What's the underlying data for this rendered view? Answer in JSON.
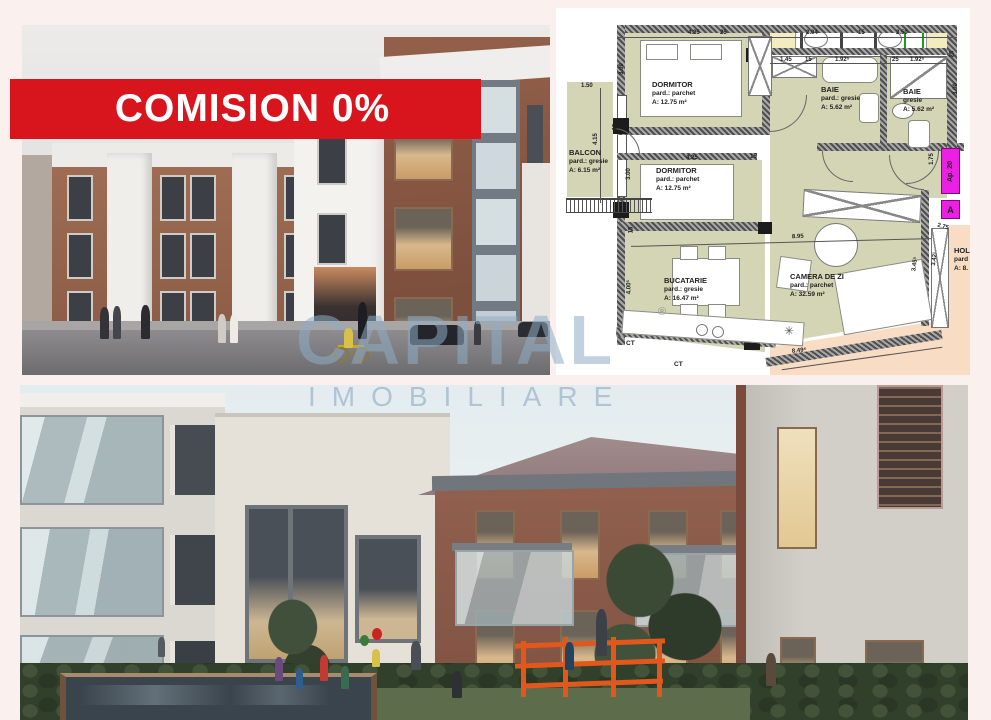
{
  "banner": {
    "label": "COMISION 0%",
    "bg": "#d8151d",
    "fg": "#ffffff"
  },
  "watermark": {
    "line1": "CAPITAL",
    "line2": "IMOBILIARE",
    "color": "#8fadc6"
  },
  "floorplan": {
    "rooms": [
      {
        "name": "DORMITOR",
        "floor": "pard.: parchet",
        "area": "A: 12.75 m²"
      },
      {
        "name": "DORMITOR",
        "floor": "pard.: parchet",
        "area": "A: 12.75 m²"
      },
      {
        "name": "BALCON",
        "floor": "pard.: gresie",
        "area": "A: 6.15 m²"
      },
      {
        "name": "BAIE",
        "floor": "pard.: gresie",
        "area": "A: 5.62 m²"
      },
      {
        "name": "BAIE",
        "floor": "gresie",
        "area": "A: 5.62 m²"
      },
      {
        "name": "BUCATARIE",
        "floor": "pard.: gresie",
        "area": "A: 16.47 m²"
      },
      {
        "name": "CAMERA DE ZI",
        "floor": "pard.: parchet",
        "area": "A: 32.59 m²"
      },
      {
        "name": "HOL",
        "floor": "pard",
        "area": "A: 8."
      }
    ],
    "dims": [
      "4.25",
      "25",
      "2.04",
      "15",
      "2.50",
      "1.45",
      "15",
      "1.92⁵",
      "25",
      "1.92⁵",
      "1.50",
      "3.09",
      "4.15",
      "15",
      "3.00",
      "4.25",
      "15",
      "25",
      "3.00",
      "15",
      "4.00⁵",
      "8.95",
      "1.75",
      "2.75",
      "3.45⁵",
      "3.42¹",
      "8.49⁵"
    ],
    "tags": {
      "apartment": "Ap. 20",
      "letter": "A"
    },
    "ct_labels": [
      "CT",
      "CT"
    ],
    "registered_mark": "®",
    "colors": {
      "room": "#d4d5b4",
      "hall": "#f8dcc4",
      "tag": "#ec1fe4"
    }
  }
}
